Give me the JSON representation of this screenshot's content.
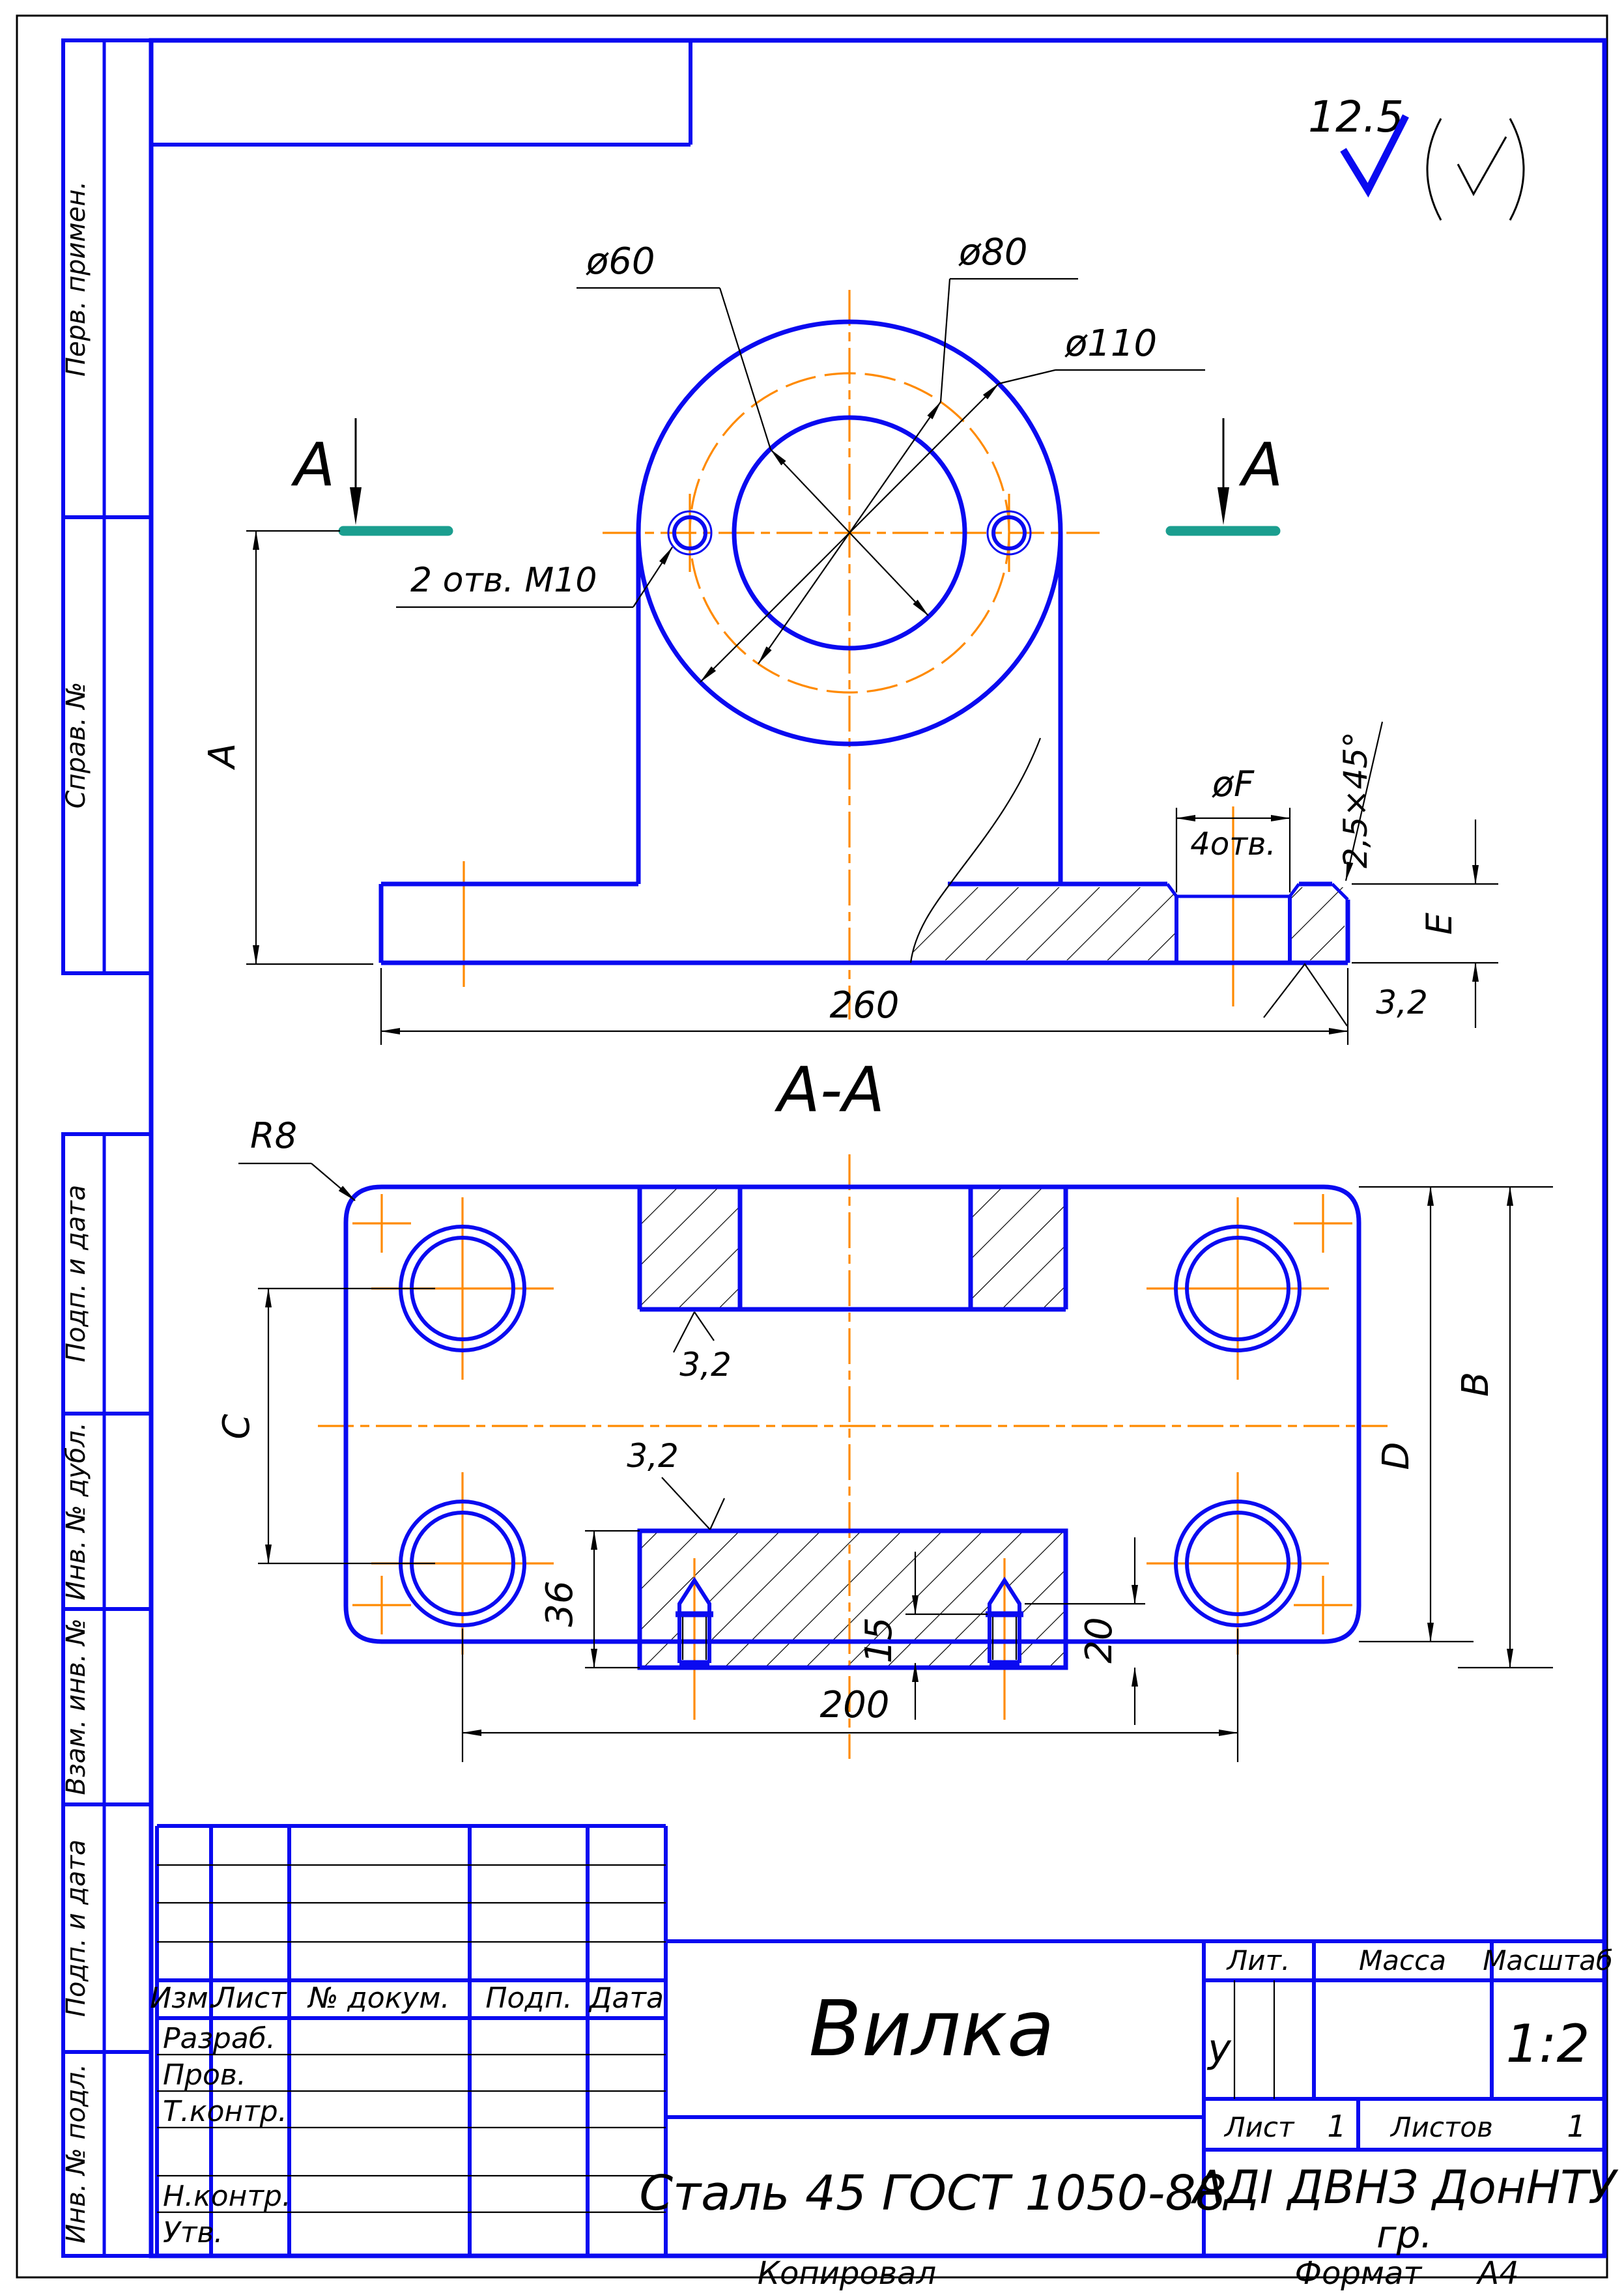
{
  "sheet": {
    "roughness_default": "12.5"
  },
  "front_view": {
    "dia60": "ø60",
    "dia80": "ø80",
    "dia110": "ø110",
    "holes_note": "2 отв. М10",
    "section_letter_left": "А",
    "section_letter_right": "А",
    "dim_height": "А",
    "dim_width": "260",
    "dia_f": "øF",
    "holes4_note": "4отв.",
    "chamfer": "2,5×45°",
    "dim_thickness": "E",
    "roughness": "3,2"
  },
  "section_view": {
    "title": "А-А",
    "radius": "R8",
    "dim_c": "C",
    "dim_d": "D",
    "dim_b": "B",
    "dim_36": "36",
    "dim_15": "15",
    "dim_20": "20",
    "dim_200": "200",
    "roughness_top": "3,2",
    "roughness_bottom": "3,2"
  },
  "title_block": {
    "cols": [
      "Изм.",
      "Лист",
      "№ докум.",
      "Подп.",
      "Дата"
    ],
    "rows": [
      "Разраб.",
      "Пров.",
      "Т.контр.",
      "Н.контр.",
      "Утв."
    ],
    "part_name": "Вилка",
    "material": "Сталь 45  ГОСТ 1050-88",
    "lit_label": "Лит.",
    "lit_value": "у",
    "mass_label": "Масса",
    "scale_label": "Масштаб",
    "scale_value": "1:2",
    "sheet_label": "Лист",
    "sheet_value": "1",
    "sheets_label": "Листов",
    "sheets_value": "1",
    "org_line1": "АДІ ДВНЗ ДонНТУ",
    "org_line2": "гр.",
    "copied_label": "Копировал",
    "format_label": "Формат",
    "format_value": "А4"
  },
  "sidebar": {
    "top": [
      "Перв. примен.",
      "Справ. №"
    ],
    "bottom": [
      "Подп. и дата",
      "Инв. № дубл.",
      "Взам. инв. №",
      "Подп. и дата",
      "Инв. № подл."
    ]
  },
  "colors": {
    "outline": "#0a0af0",
    "centerline": "#ff8a00",
    "section_mark": "#1b9e8f",
    "thin_line": "#000000"
  }
}
